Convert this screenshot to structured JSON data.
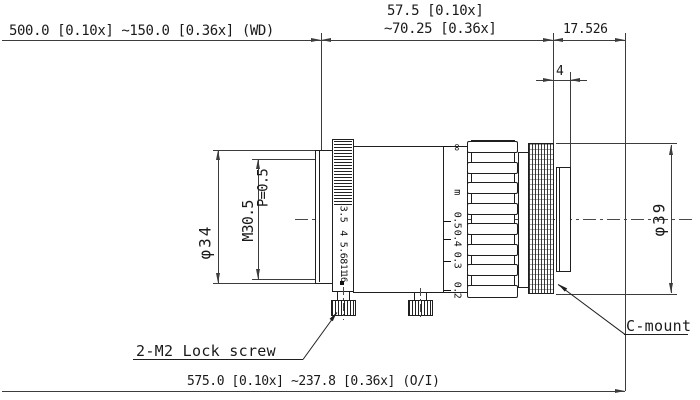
{
  "drawing": {
    "texts": {
      "dim_wd": "500.0 [0.10x] ~150.0 [0.36x] (WD)",
      "dim_front_line1": "57.5 [0.10x]",
      "dim_front_line2": "~70.25 [0.36x]",
      "dim_flange": "17.526",
      "dim_thread_length": "4",
      "dim_oi": "575.0 [0.10x] ~237.8 [0.36x] (O/I)",
      "dim_front_diameter": "φ34",
      "dim_filter_thread": "M30.5",
      "dim_thread_pitch": "P=0.5",
      "dim_rear_diameter": "φ39",
      "label_lock_screw": "2-M2 Lock screw",
      "label_mount": "C-mount"
    },
    "aperture_scale": [
      "3.5",
      "4",
      "5.6",
      "8",
      "11",
      "16"
    ],
    "focus_scale": [
      "∞",
      "m",
      "0.5",
      "0.4",
      "0.3",
      "0.2"
    ],
    "colors": {
      "outline": "#1f1f1f",
      "dimension": "#3c3c3c",
      "background": "#ffffff"
    }
  }
}
